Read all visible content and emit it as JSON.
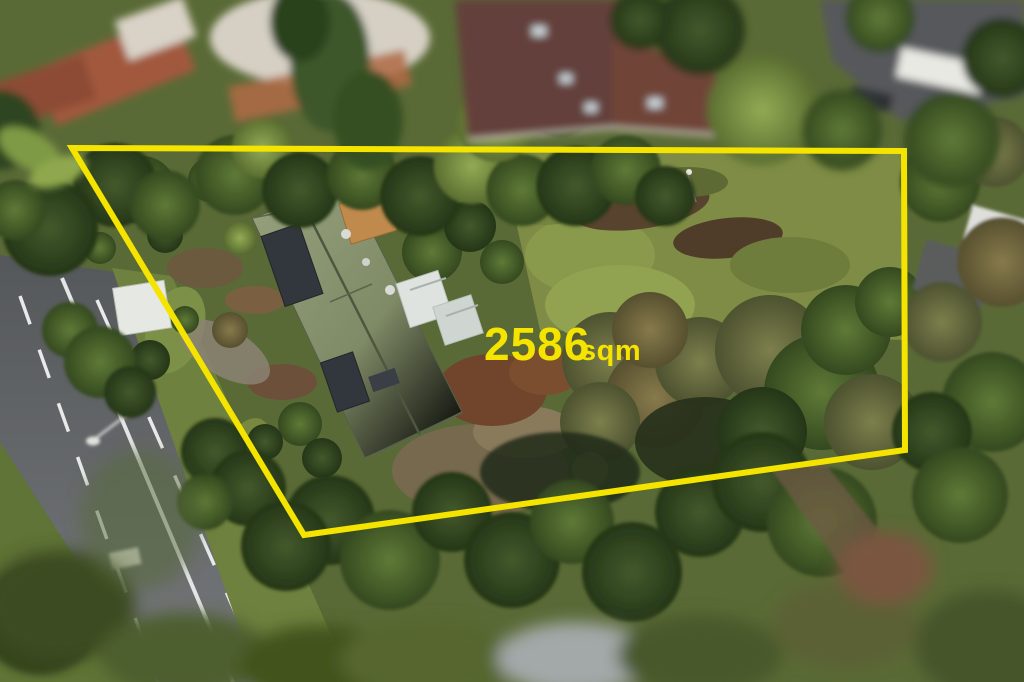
{
  "annotation": {
    "area_value": "2586",
    "area_unit": "sqm",
    "boundary_color": "#F4E400",
    "boundary_stroke_width": "6",
    "boundary_points": "72,148 904,151 905,450 304,535"
  }
}
